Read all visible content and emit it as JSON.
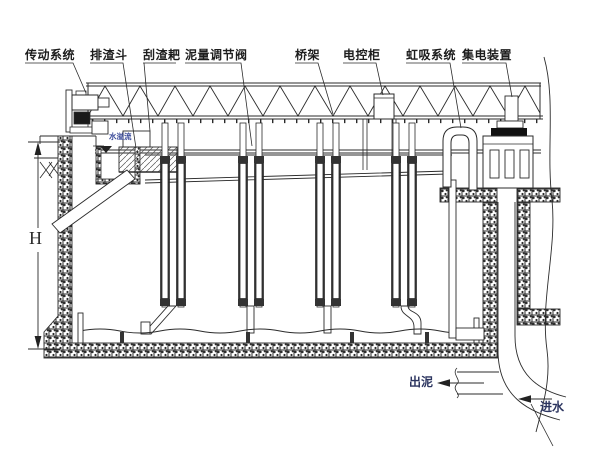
{
  "colors": {
    "background": "#ffffff",
    "line": "#2b2b2b",
    "label_text": "#1d1d1d",
    "small_blue_label": "#3a4a99",
    "flow_label": "#2c3560",
    "fill_dark": "#1a1a1a"
  },
  "labels": {
    "drive_system": "传动系统",
    "slag_hopper": "排渣斗",
    "scum_rake": "刮渣耙",
    "mud_valve": "泥量调节阀",
    "bridge_frame": "桥架",
    "control_cabinet": "电控柜",
    "siphon_system": "虹吸系统",
    "collector_device": "集电装置",
    "water_overflow": "水溢流",
    "height_dim": "H",
    "mud_out": "出泥",
    "water_in": "进水"
  },
  "icons": {
    "water_level": "filled-down-triangle",
    "mud_out_arrow": "left-arrow",
    "water_in_arrow": "left-arrow",
    "dim_arrows": "up-down-dimension-arrows"
  }
}
